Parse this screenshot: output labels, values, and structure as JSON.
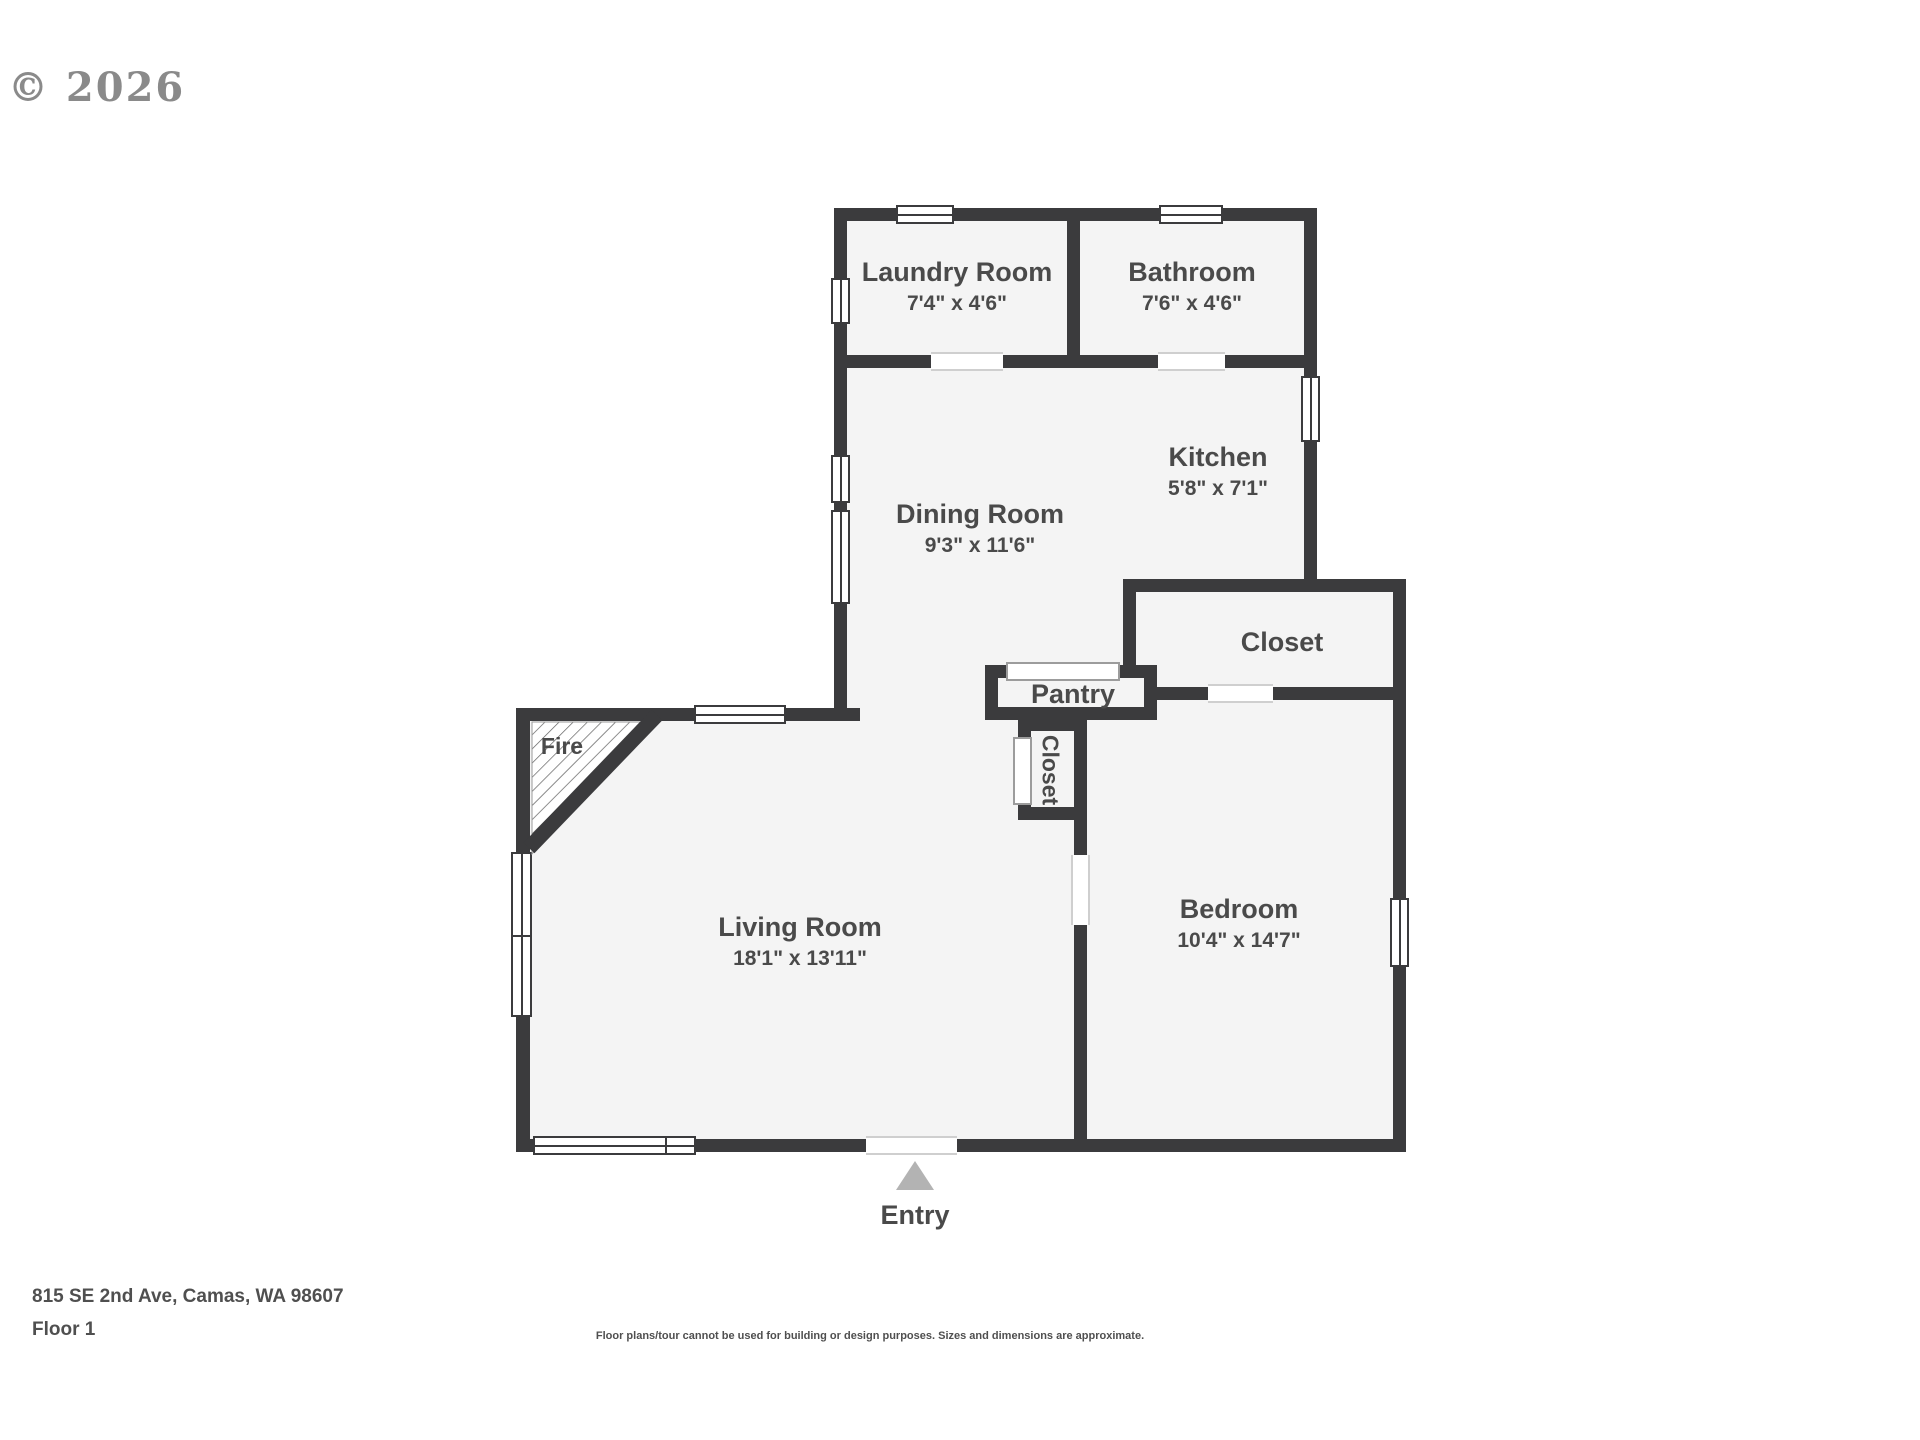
{
  "watermark": "© 2026",
  "colors": {
    "wall": "#3b3b3d",
    "room_fill": "#f4f4f4",
    "label": "#4a4a4a",
    "watermark": "#8a8a8a",
    "entry_arrow": "#b3b3b3"
  },
  "rooms": {
    "laundry": {
      "name": "Laundry Room",
      "dims": "7'4\" x 4'6\""
    },
    "bathroom": {
      "name": "Bathroom",
      "dims": "7'6\" x 4'6\""
    },
    "kitchen": {
      "name": "Kitchen",
      "dims": "5'8\" x 7'1\""
    },
    "dining": {
      "name": "Dining Room",
      "dims": "9'3\" x 11'6\""
    },
    "closet_upper": {
      "name": "Closet"
    },
    "pantry": {
      "name": "Pantry"
    },
    "closet_hall": {
      "name": "Closet"
    },
    "living": {
      "name": "Living Room",
      "dims": "18'1\" x 13'11\""
    },
    "bedroom": {
      "name": "Bedroom",
      "dims": "10'4\" x 14'7\""
    }
  },
  "annotations": {
    "fireplace": "Fire",
    "entry": "Entry"
  },
  "footer": {
    "address": "815 SE 2nd Ave, Camas, WA 98607",
    "floor": "Floor 1",
    "disclaimer": "Floor plans/tour cannot be used for building or design purposes. Sizes and dimensions are approximate."
  }
}
